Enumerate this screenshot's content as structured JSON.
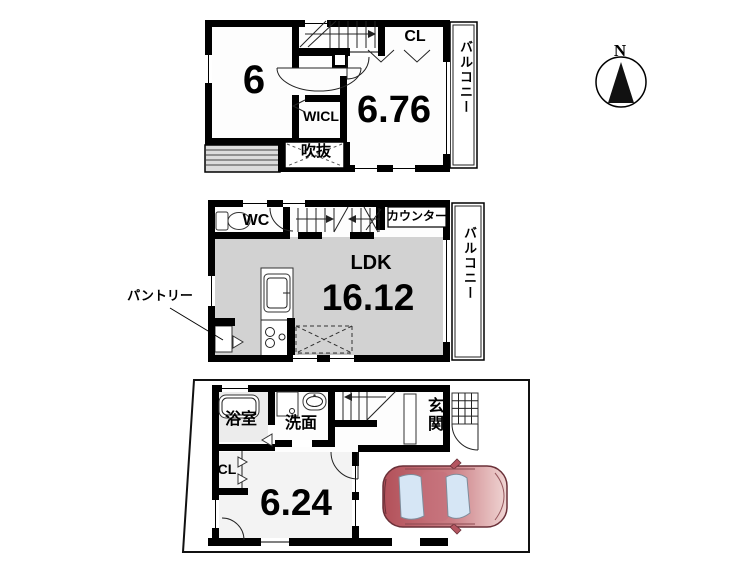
{
  "colors": {
    "wall": "#000000",
    "ldk_floor": "#d2d2d2",
    "bath_floor": "#ececec",
    "room_floor": "#f3f3f3",
    "car_body": "#c0606a",
    "car_window": "#d6e6f5"
  },
  "compass": {
    "label": "N"
  },
  "floor3": {
    "room6_label": "6",
    "closet_label": "CL",
    "wicl_label": "WICL",
    "void_label": "吹抜",
    "room676_label": "6.76",
    "balcony_label": "バルコニー"
  },
  "floor2": {
    "wc_label": "WC",
    "counter_label": "カウンター",
    "ldk_label": "LDK",
    "ldk_size": "16.12",
    "pantry_label": "パントリー",
    "balcony_label": "バルコニー"
  },
  "floor1": {
    "bath_label": "浴室",
    "washroom_label": "洗面",
    "entrance_label": "玄関",
    "closet_label": "CL",
    "room624_label": "6.24"
  }
}
